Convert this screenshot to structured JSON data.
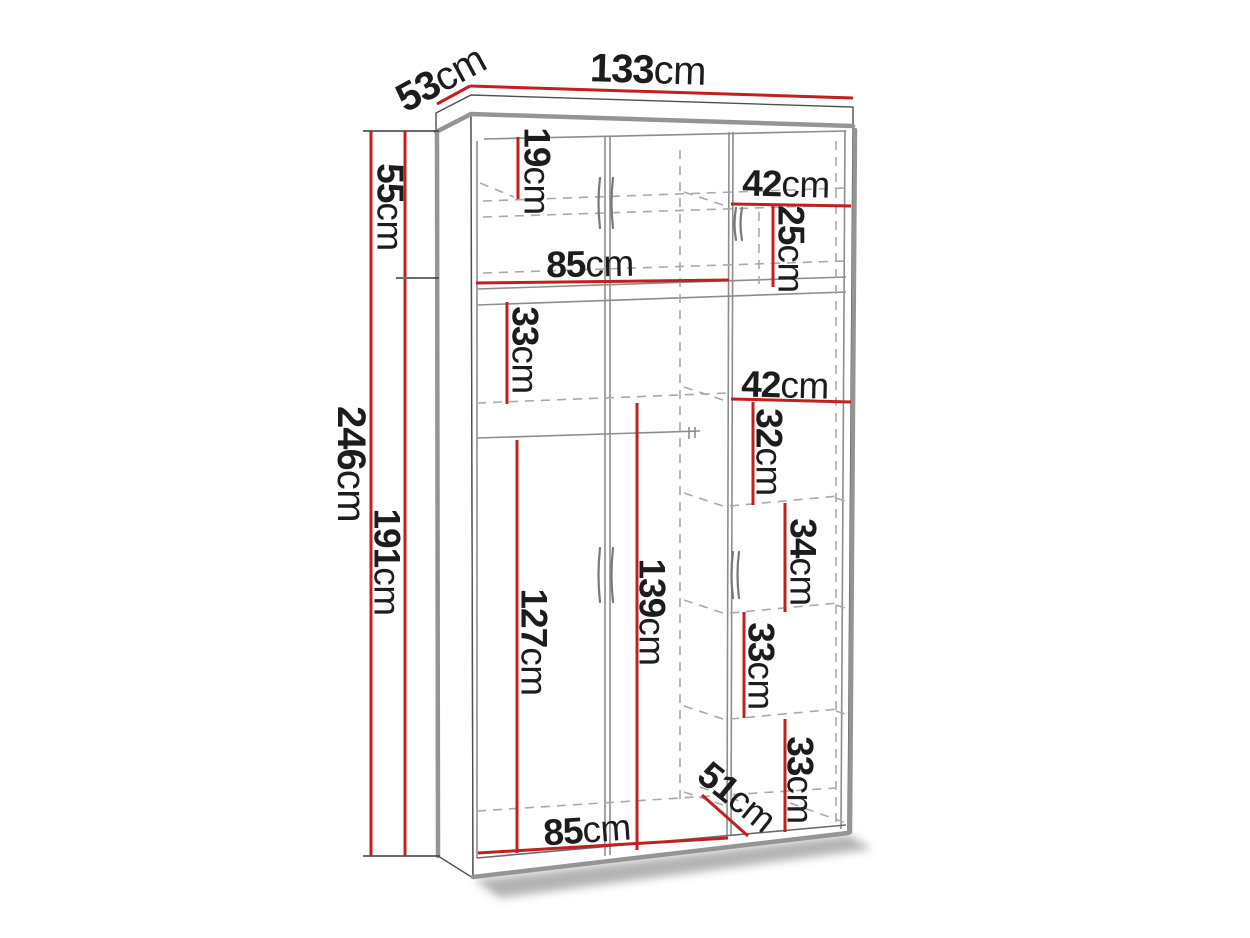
{
  "diagram": {
    "kind": "furniture-dimension-diagram",
    "subject": "two-section wardrobe, front three-quarter line drawing",
    "unit": "cm",
    "overall": {
      "width_cm": 133,
      "depth_cm": 53,
      "height_cm": 246,
      "upper_section_height_cm": 55,
      "lower_section_height_cm": 191
    },
    "colors": {
      "dimension_line": "#c22020",
      "label_text": "#1c1c1c",
      "edge_dark": "#4f4f4f",
      "edge_shade": "#949494",
      "interior_line": "#8d8d8d",
      "hidden_line": "#a9a9a9",
      "background": "#ffffff"
    },
    "labels": [
      {
        "id": "depth",
        "value": "53",
        "unit": "cm"
      },
      {
        "id": "width",
        "value": "133",
        "unit": "cm"
      },
      {
        "id": "top-shelf-gap",
        "value": "19",
        "unit": "cm"
      },
      {
        "id": "top-right-width",
        "value": "42",
        "unit": "cm"
      },
      {
        "id": "top-right-height",
        "value": "25",
        "unit": "cm"
      },
      {
        "id": "top-shelf-width",
        "value": "85",
        "unit": "cm"
      },
      {
        "id": "upper-section",
        "value": "55",
        "unit": "cm"
      },
      {
        "id": "left-cubby",
        "value": "33",
        "unit": "cm"
      },
      {
        "id": "mid-right-width",
        "value": "42",
        "unit": "cm"
      },
      {
        "id": "right-shelf-1",
        "value": "32",
        "unit": "cm"
      },
      {
        "id": "total-height",
        "value": "246",
        "unit": "cm"
      },
      {
        "id": "lower-section",
        "value": "191",
        "unit": "cm"
      },
      {
        "id": "right-shelf-2",
        "value": "34",
        "unit": "cm"
      },
      {
        "id": "hanging-space",
        "value": "127",
        "unit": "cm"
      },
      {
        "id": "left-inner-height",
        "value": "139",
        "unit": "cm"
      },
      {
        "id": "right-shelf-3",
        "value": "33",
        "unit": "cm"
      },
      {
        "id": "right-shelf-4",
        "value": "33",
        "unit": "cm"
      },
      {
        "id": "inner-depth",
        "value": "51",
        "unit": "cm"
      },
      {
        "id": "bottom-width",
        "value": "85",
        "unit": "cm"
      }
    ]
  }
}
